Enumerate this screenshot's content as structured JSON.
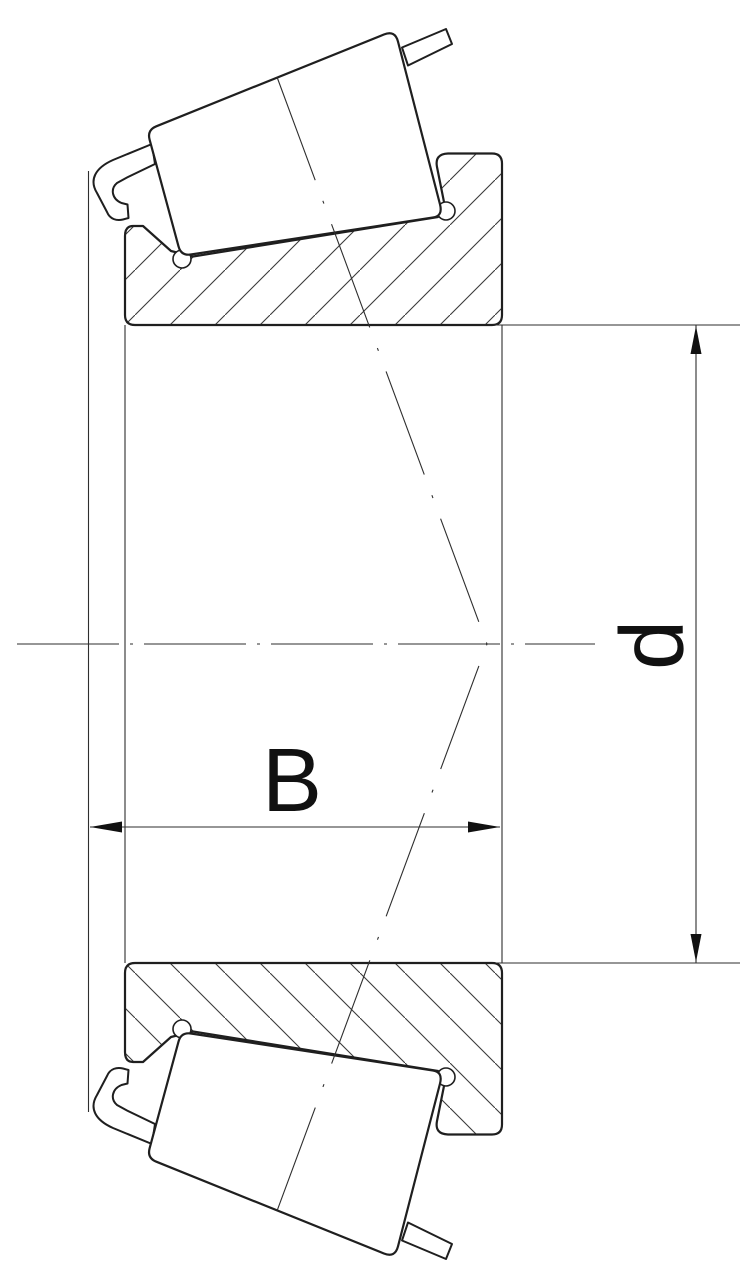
{
  "drawing": {
    "labels": {
      "width_dimension": "B",
      "bore_dimension": "d"
    },
    "colors": {
      "background": "#ffffff",
      "outline": "#1f1f1f",
      "thin_line": "#2e2e2e",
      "hatch": "#3a3a3a",
      "text": "#111111"
    }
  }
}
